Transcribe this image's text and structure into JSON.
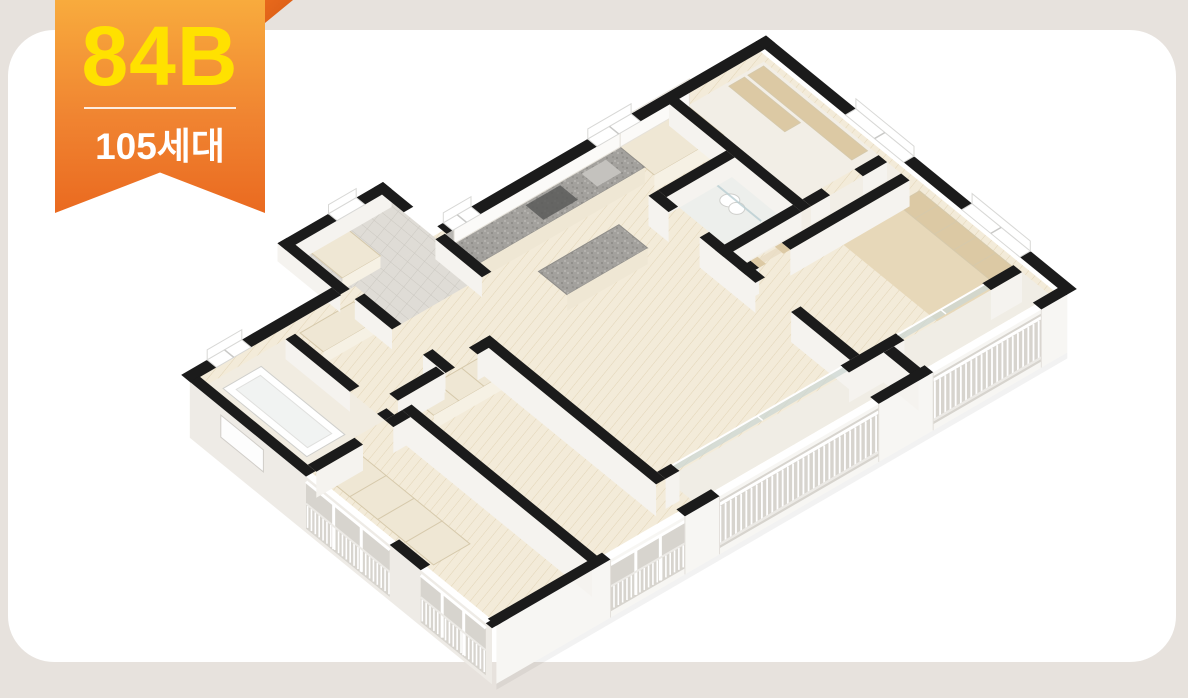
{
  "badge": {
    "unit_code": "84B",
    "unit_count": "105세대"
  },
  "figure": {
    "kind": "3d-isometric-floor-plan"
  },
  "palette": {
    "page_bg": "#e7e2dd",
    "card_bg": "#ffffff",
    "ribbon_top": "#f8ab3d",
    "ribbon_mid": "#f08431",
    "ribbon_bottom": "#ea6a20",
    "ribbon_fold": "#d85c14",
    "badge_code_color": "#ffe100",
    "badge_count_color": "#ffffff",
    "wall_black": "#1b1b1b",
    "wood_floor": "#f3ebd9",
    "wood_line": "#e2d4b6",
    "tan_rug": "#e7d8b9",
    "wood_cabinet": "#dcc9a4",
    "cream_cabinet": "#efe7d4",
    "cabinet_line": "#d6c9ab",
    "granite": "#a3a19d",
    "facade_front": "#f7f6f3",
    "facade_left": "#eeebe6",
    "wall_face": "#f5f3ef",
    "opening": "#d7d4ce",
    "railing": "#ffffff",
    "glass": "#ccd7d3",
    "tile": "#dfdcd6",
    "tile_line": "#cbc8c1",
    "bath_floor": "#edefec",
    "bath2_floor": "#f1ece1",
    "nook_floor": "#f2eee6",
    "balcony_floor": "#f0ede5",
    "fixture_white": "#ffffff",
    "fixture_stroke": "#cfcfcc"
  }
}
